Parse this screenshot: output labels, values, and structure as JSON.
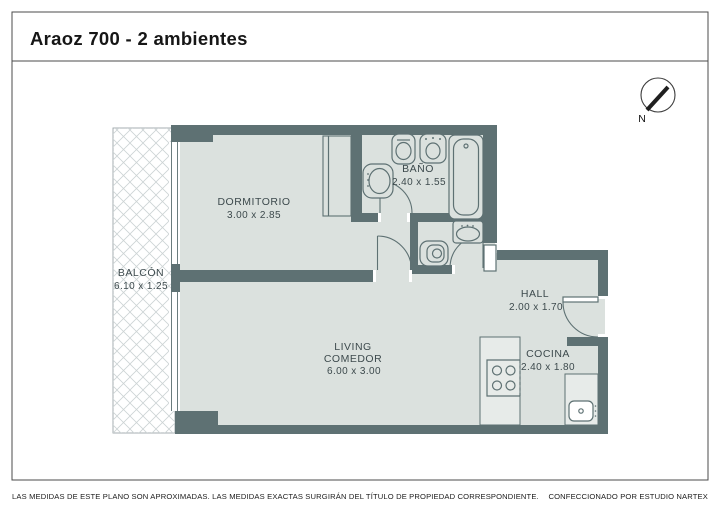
{
  "header": {
    "title": "Araoz 700 - 2 ambientes"
  },
  "compass": {
    "label": "N"
  },
  "rooms": {
    "dormitorio": {
      "name": "DORMITORIO",
      "dims": "3.00 x 2.85"
    },
    "bano": {
      "name": "BAÑO",
      "dims": "2.40 x 1.55"
    },
    "balcon": {
      "name": "BALCÓN",
      "dims": "6.10 x 1.25"
    },
    "living": {
      "name": "LIVING",
      "name2": "COMEDOR",
      "dims": "6.00 x 3.00"
    },
    "hall": {
      "name": "HALL",
      "dims": "2.00 x 1.70"
    },
    "cocina": {
      "name": "COCINA",
      "dims": "2.40 x 1.80"
    }
  },
  "footer": {
    "disclaimer": "LAS MEDIDAS  DE ESTE PLANO SON APROXIMADAS. LAS MEDIDAS EXACTAS SURGIRÁN DEL TÍTULO DE PROPIEDAD CORRESPONDIENTE.",
    "credit": "CONFECCIONADO POR ESTUDIO NARTEX"
  },
  "colors": {
    "wall": "#5e7173",
    "floor": "#dbe1de",
    "counter": "#e7ebe9",
    "hatch": "#ccd3d4",
    "label_text": "#3d4a4d",
    "frame": "#4b4b4b"
  }
}
